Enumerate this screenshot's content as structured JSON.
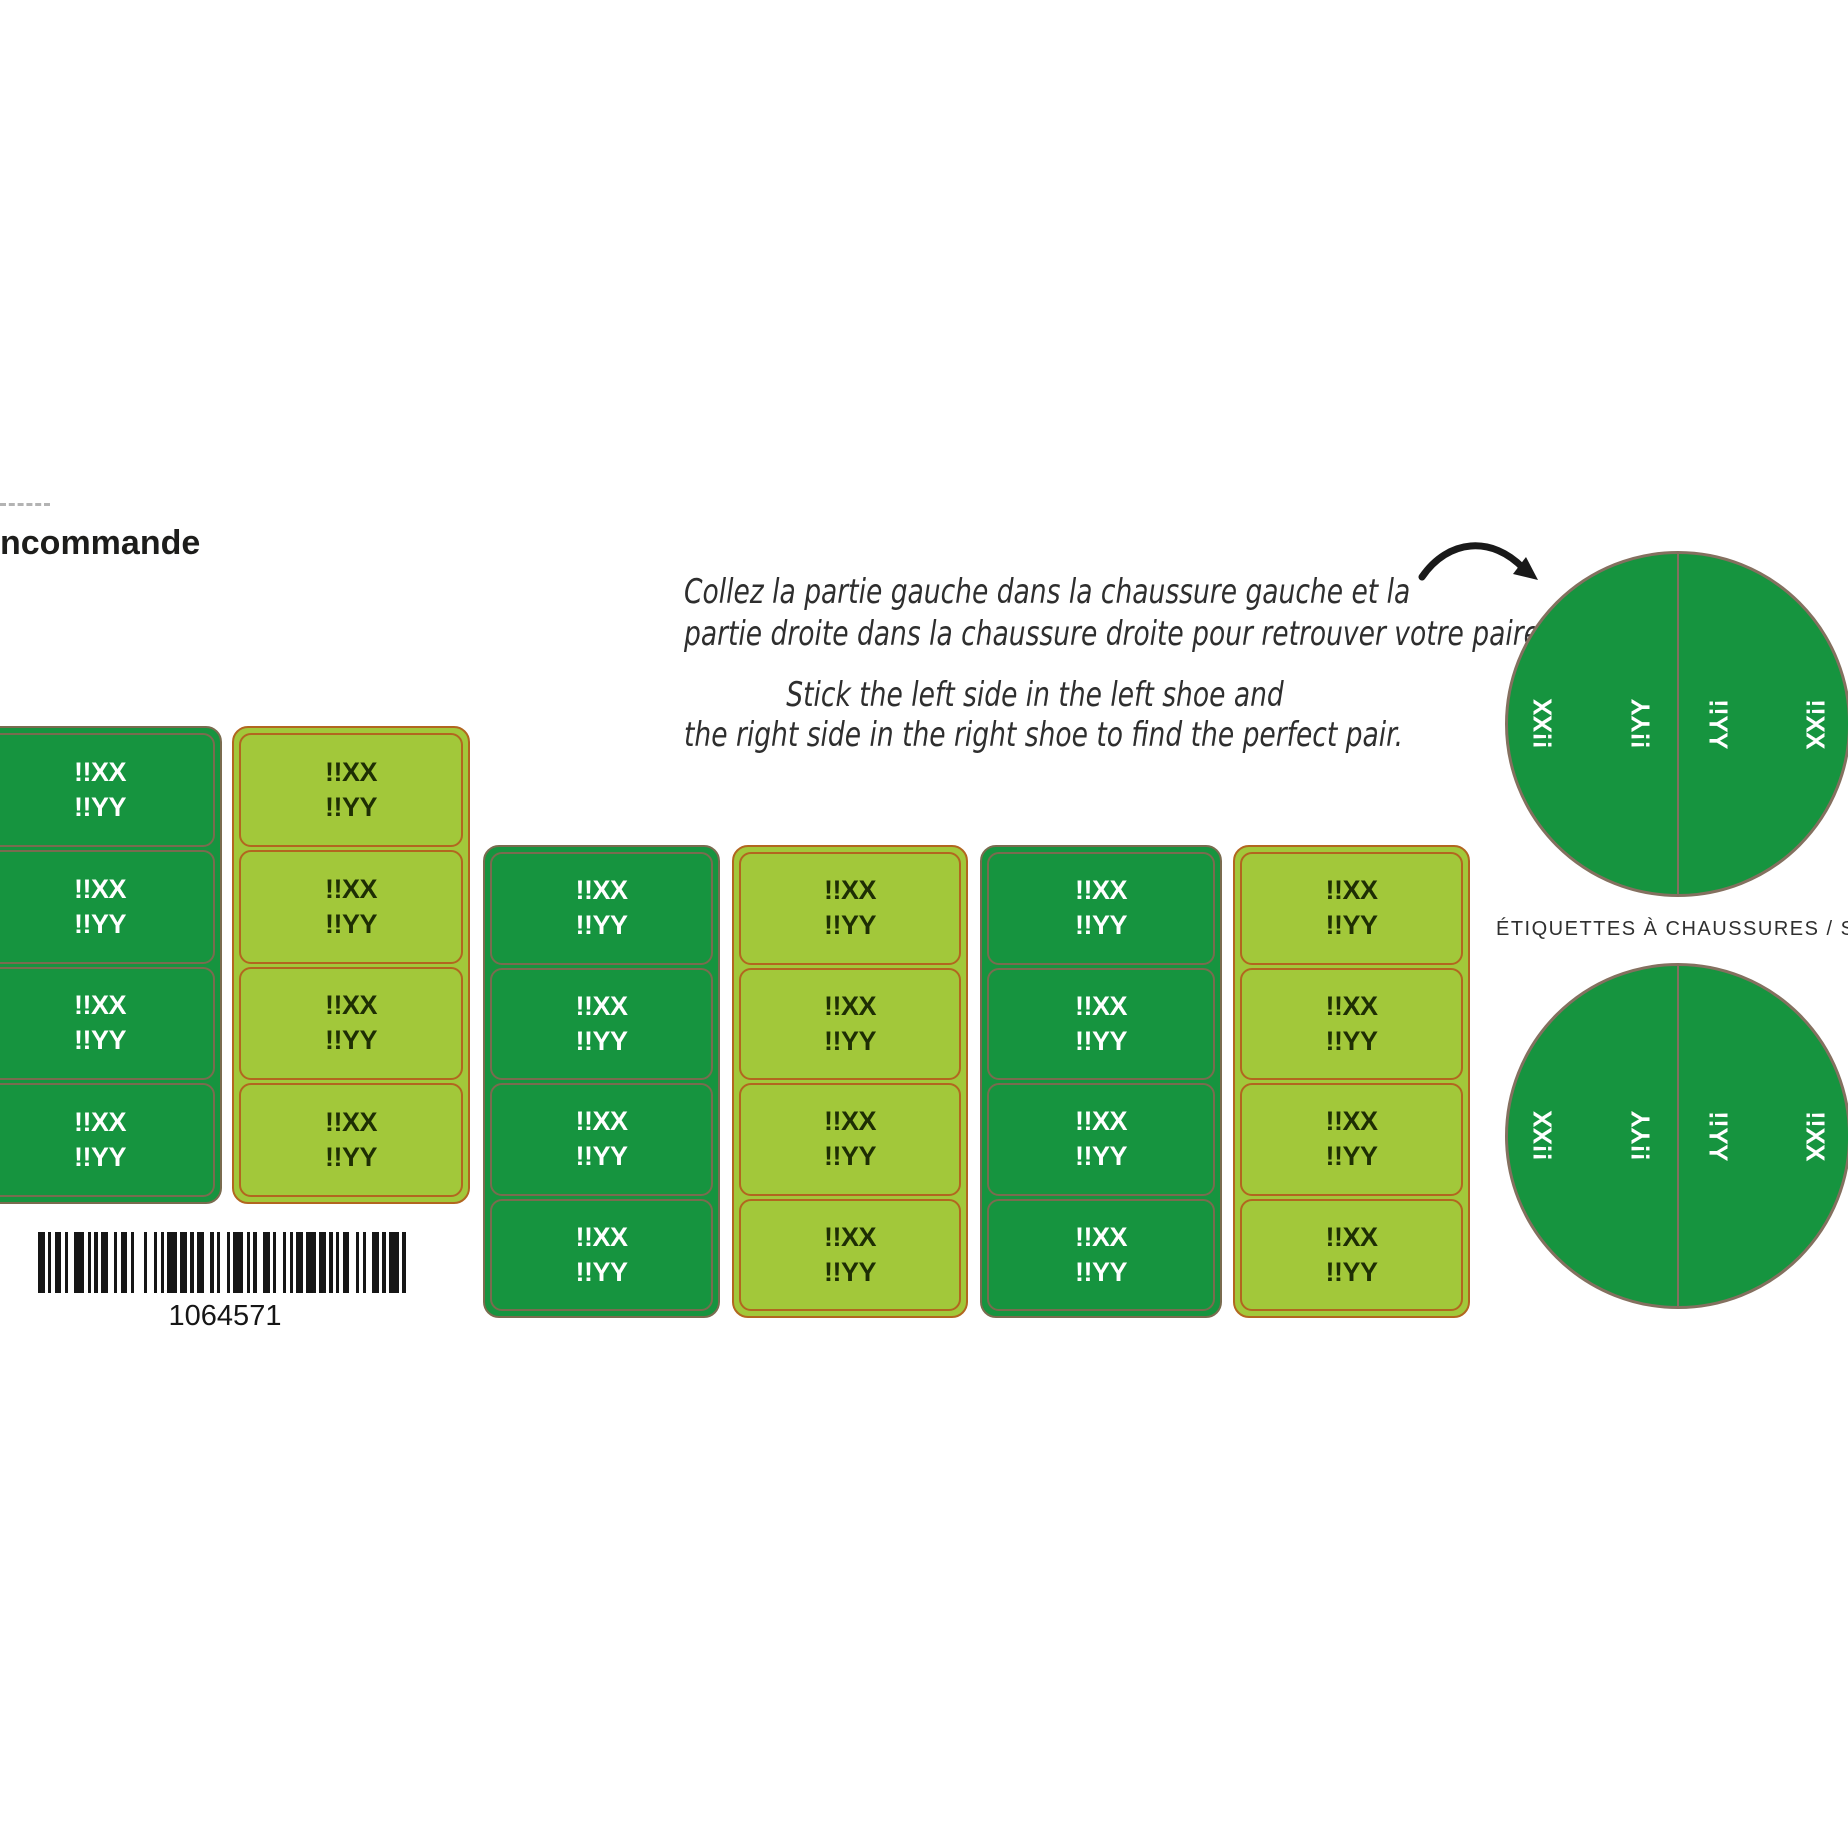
{
  "page": {
    "order_form_label": "ncommande",
    "barcode_number": "1064571"
  },
  "instructions": {
    "fr": [
      "Collez la partie gauche dans la chaussure gauche et la",
      "partie droite dans la chaussure droite pour retrouver votre paire."
    ],
    "en": [
      "Stick the left side in the left shoe and",
      "the right side in the right shoe to find the perfect pair."
    ]
  },
  "label_text": {
    "line1": "!!XX",
    "line2": "!!YY"
  },
  "sheet": {
    "columns": [
      {
        "id": "label-column-1",
        "variant": "dark",
        "rows": 4
      },
      {
        "id": "label-column-2",
        "variant": "light",
        "rows": 4
      },
      {
        "id": "label-column-3",
        "variant": "dark",
        "rows": 4
      },
      {
        "id": "label-column-4",
        "variant": "light",
        "rows": 4
      },
      {
        "id": "label-column-5",
        "variant": "dark",
        "rows": 4
      },
      {
        "id": "label-column-6",
        "variant": "light",
        "rows": 4
      }
    ]
  },
  "shoe_labels": {
    "caption": "ÉTIQUETTES À CHAUSSURES / SHOE LABELS",
    "left_half": [
      "!!XX",
      "!!YY"
    ],
    "right_half": [
      "!!YY",
      "!!XX"
    ]
  },
  "colors": {
    "dark_green": "#16943f",
    "light_green": "#a2c83a",
    "dark_die": "#7a6b4f",
    "light_die": "#b2661f",
    "circle_die": "#84705f",
    "light_text": "#1e2e04",
    "title": "#1d1d1b",
    "instructions": "#2e2e2e",
    "caption": "#2f2f2f",
    "dash": "#b3b3b3"
  }
}
